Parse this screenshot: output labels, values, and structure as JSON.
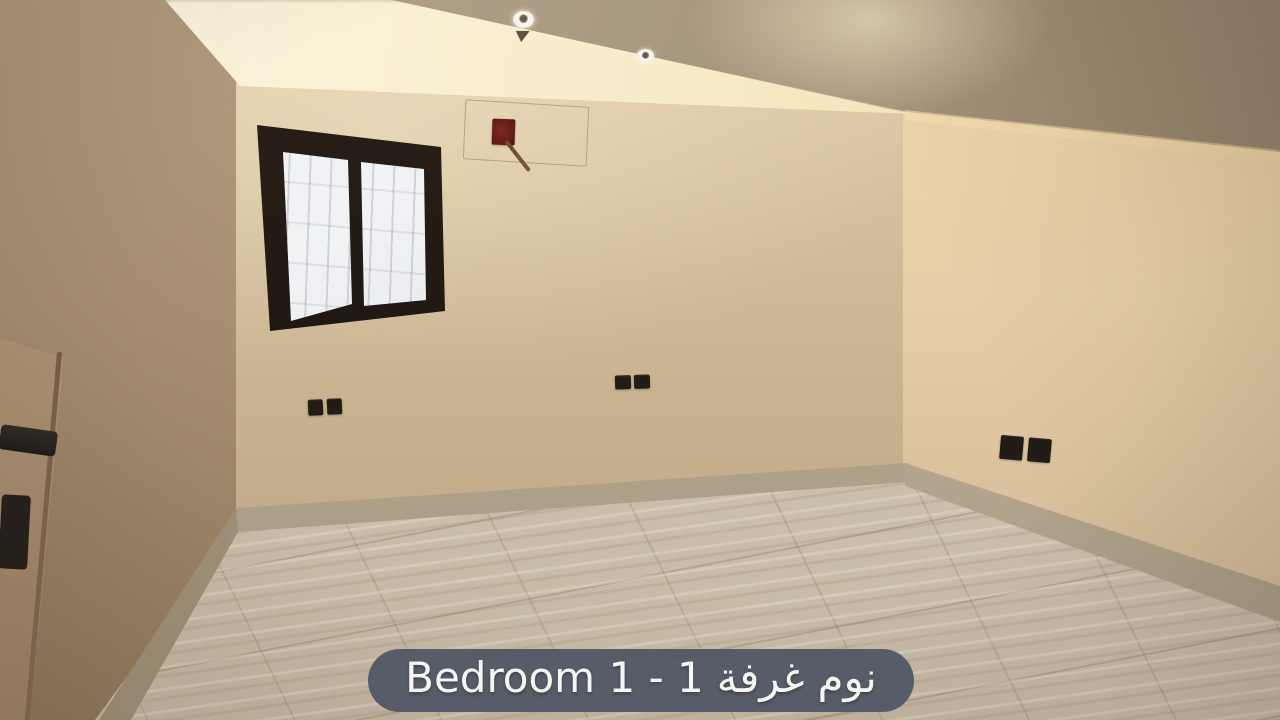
{
  "overlay": {
    "caption": {
      "latin": "Bedroom 1 - 1",
      "arabic_first": "غرفة",
      "arabic_second": "نوم",
      "full_visible_text": "Bedroom 1 - 1 غرفة نوم",
      "pill_color": "#4e5664",
      "text_color": "#f5f5f2"
    }
  },
  "scene": {
    "type": "empty-bedroom-interior-photo",
    "palette": {
      "wall_beige": "#cdb795",
      "cove_glow": "#fbf2da",
      "ceiling_taupe": "#a39279",
      "floor_greige": "#d0c4b2",
      "skirting_grey": "#b2a38e",
      "window_frame_dark": "#1f1813",
      "junction_box_red": "#6e2019"
    },
    "objects": [
      "tray-ceiling-with-cove-lighting",
      "two-recessed-downlights",
      "dark-framed-frosted-window-two-panes",
      "red-electrical-junction-box-with-wire",
      "pencil-marked-patch-outline",
      "double-switch-back-wall-left",
      "double-outlet-back-wall-right",
      "double-outlet-right-wall",
      "open-door-edge-with-black-handle-and-lock",
      "marble-look-floor-tiles",
      "stone-skirting-boards"
    ]
  }
}
